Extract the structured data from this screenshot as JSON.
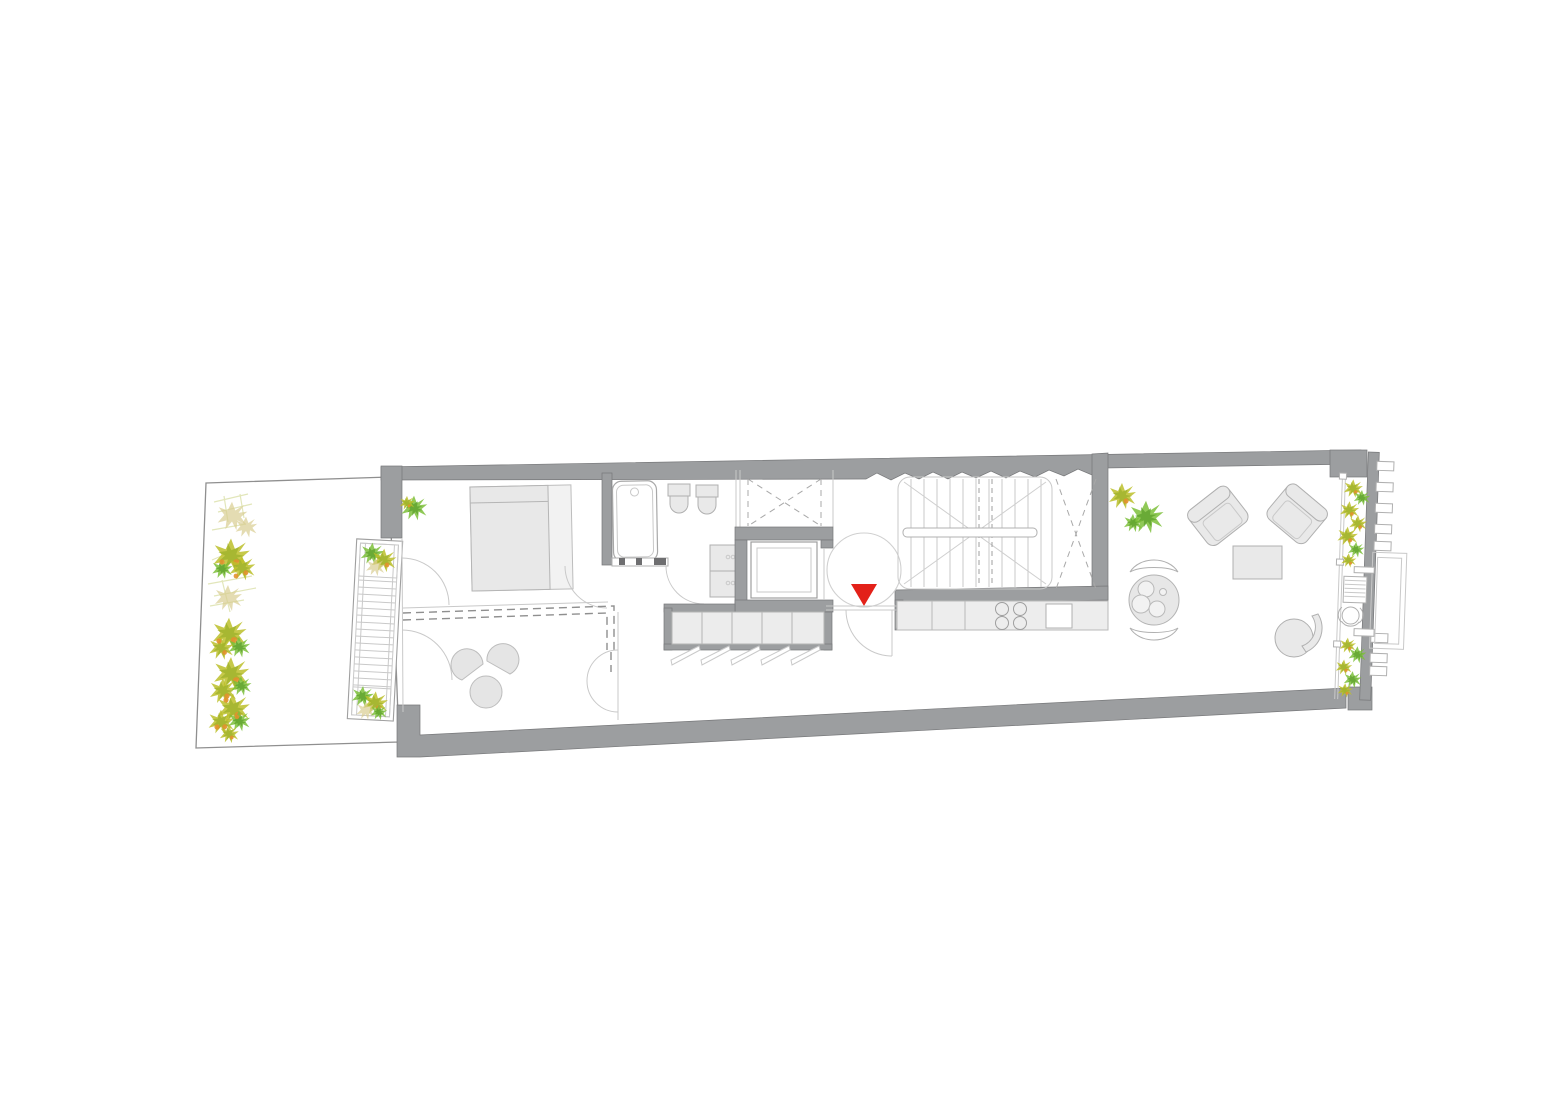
{
  "colors": {
    "background": "#ffffff",
    "wall": "#9c9ea0",
    "wall_edge": "#77787a",
    "wall_dark": "#6e6e70",
    "line": "#9f9f9f",
    "line_light": "#c9c9c9",
    "furniture_fill": "#e9e9e9",
    "furniture_stroke": "#b0b0b0",
    "counter_fill": "#ededed",
    "dash": "#8f8f8f",
    "entry_marker": "#e32119",
    "plant_yellow": "#bcbf2a",
    "plant_olive": "#9fb32c",
    "plant_green": "#7dc03a",
    "plant_green_dark": "#5fa32e",
    "plant_orange": "#e2912e",
    "plant_tan": "#d8cd92",
    "sketch": "#dde2ae"
  },
  "drawing": {
    "type": "residential floor plan, top view, no text labels",
    "entry_marker": {
      "shape": "triangle-down",
      "color_ref": "entry_marker"
    },
    "areas": [
      "garden-terrace",
      "exterior-stair",
      "bedroom",
      "sitting-area",
      "bathroom",
      "void-shafts",
      "elevator",
      "wardrobe",
      "entry-landing",
      "main-staircase",
      "kitchen",
      "living-room",
      "dining-area",
      "facade-balcony"
    ],
    "fixtures": {
      "kitchen_burners": 4,
      "kitchen_sinks": 1,
      "wardrobe_doors": 5,
      "wall_hung_wc": 2,
      "armchairs": 2,
      "curved_benches": 2
    }
  }
}
